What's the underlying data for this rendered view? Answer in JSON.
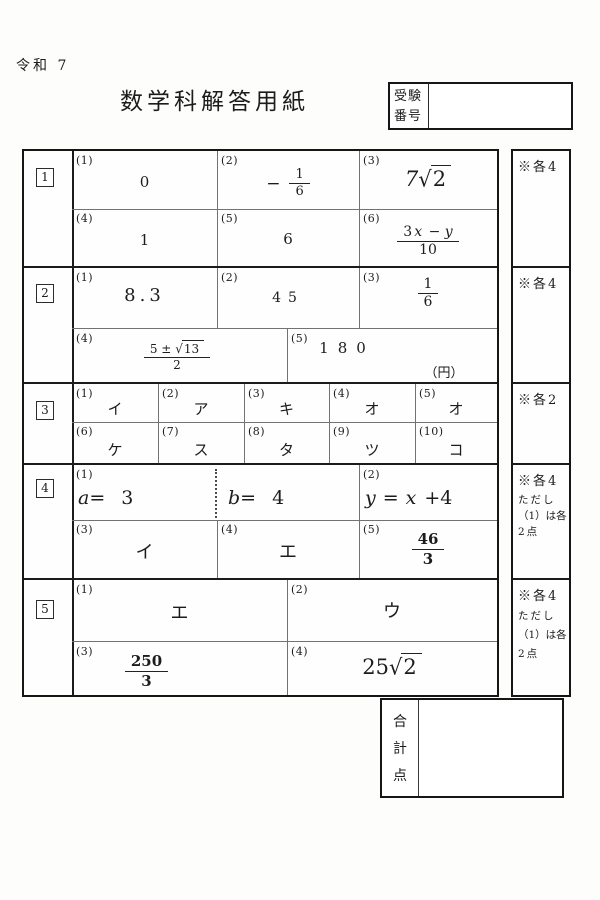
{
  "colors": {
    "ink": "#1c1c1c",
    "paper": "#fdfdfc"
  },
  "header": {
    "era": "令和 7",
    "title": "数学科解答用紙",
    "examinee_label_top": "受験",
    "examinee_label_bottom": "番号"
  },
  "sec_nums": [
    "1",
    "2",
    "3",
    "4",
    "5"
  ],
  "notes": {
    "n1": "※各4",
    "n2": "※各4",
    "n3": "※各2",
    "n4": "※各4",
    "n4_sub1": "ただし",
    "n4_sub2": "（1）は各",
    "n4_sub3": "2点",
    "n5": "※各4",
    "n5_sub1": "ただし",
    "n5_sub2": "（1）は各",
    "n5_sub3": "2点"
  },
  "s1": {
    "labels": [
      "(1)",
      "(2)",
      "(3)",
      "(4)",
      "(5)",
      "(6)"
    ],
    "v1": "0",
    "v2_sign": "−",
    "v2_num": "1",
    "v2_den": "6",
    "v3_coef": "7",
    "v3_sqrt": "√",
    "v3_rad": "2",
    "v4": "1",
    "v5": "6",
    "v6_num_a": "3",
    "v6_num_b": "x",
    "v6_num_c": "−",
    "v6_num_d": "y",
    "v6_den": "10"
  },
  "s2": {
    "labels": [
      "(1)",
      "(2)",
      "(3)",
      "(4)",
      "(5)"
    ],
    "v1": "8.3",
    "v2": "45",
    "v3_num": "1",
    "v3_den": "6",
    "v4_num": "5 ±",
    "v4_sqrt": "√",
    "v4_rad": "13",
    "v4_den": "2",
    "v5": "180",
    "v5_unit": "（円）"
  },
  "s3": {
    "labels": [
      "(1)",
      "(2)",
      "(3)",
      "(4)",
      "(5)",
      "(6)",
      "(7)",
      "(8)",
      "(9)",
      "(10)"
    ],
    "values": [
      "イ",
      "ア",
      "キ",
      "オ",
      "オ",
      "ケ",
      "ス",
      "タ",
      "ツ",
      "コ"
    ]
  },
  "s4": {
    "labels": [
      "(1)",
      "(2)",
      "(3)",
      "(4)",
      "(5)"
    ],
    "v1a_var": "a",
    "v1a_eq": "=",
    "v1a_val": "3",
    "v1b_var": "b",
    "v1b_eq": "=",
    "v1b_val": "4",
    "v2_lhs": "y",
    "v2_eq": "=",
    "v2_x": "x",
    "v2_rest": "+4",
    "v3": "イ",
    "v4": "エ",
    "v5_num": "46",
    "v5_den": "3"
  },
  "s5": {
    "labels": [
      "(1)",
      "(2)",
      "(3)",
      "(4)"
    ],
    "v1": "エ",
    "v2": "ウ",
    "v3_num": "250",
    "v3_den": "3",
    "v4_coef": "25",
    "v4_sqrt": "√",
    "v4_rad": "2"
  },
  "footer": {
    "total_1": "合",
    "total_2": "計",
    "total_3": "点"
  }
}
